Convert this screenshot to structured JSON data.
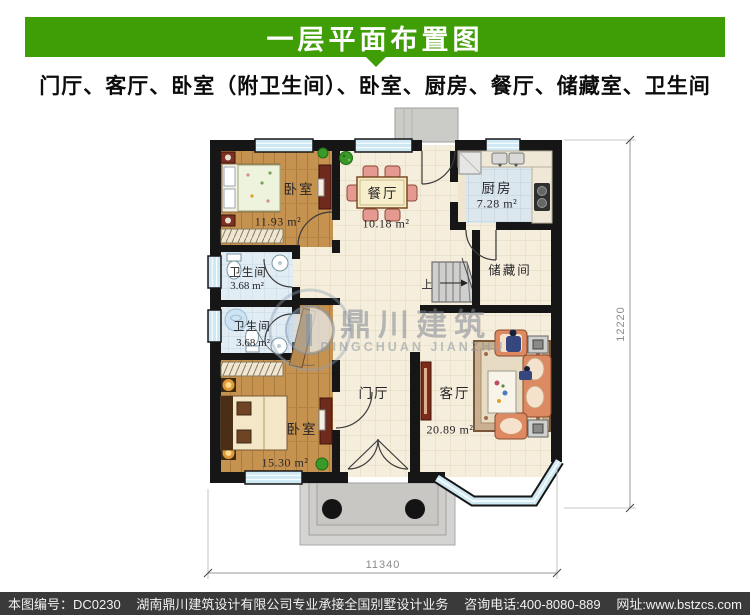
{
  "header": {
    "title": "一层平面布置图",
    "subtitle": "门厅、客厅、卧室（附卫生间）、卧室、厨房、餐厅、储藏室、卫生间",
    "banner_color": "#3f9e06"
  },
  "plan": {
    "rooms": {
      "bedroom_top": {
        "name": "卧室",
        "area": "11.93 m²"
      },
      "dining": {
        "name": "餐厅",
        "area": "10.18 m²"
      },
      "kitchen": {
        "name": "厨房",
        "area": "7.28 m²"
      },
      "bath_top": {
        "name": "卫生间",
        "area": "3.68 m²"
      },
      "bath_bottom": {
        "name": "卫生间",
        "area": "3.68 m²"
      },
      "storage": {
        "name": "储藏间"
      },
      "bedroom_bottom": {
        "name": "卧室",
        "area": "15.30 m²"
      },
      "foyer": {
        "name": "门厅"
      },
      "living": {
        "name": "客厅",
        "area": "20.89 m²"
      }
    },
    "stairs_up_label": "上",
    "dimensions": {
      "width": "11340",
      "height": "12220"
    },
    "watermark": {
      "cn": "鼎川建筑",
      "en": "DINGCHUAN JIANZHU"
    }
  },
  "footer": {
    "plan_no": "本图编号：DC0230",
    "company": "湖南鼎川建筑设计有限公司专业承接全国别墅设计业务",
    "phone": "咨询电话:400-8080-889",
    "website": "网址:www.bstzcs.com"
  }
}
